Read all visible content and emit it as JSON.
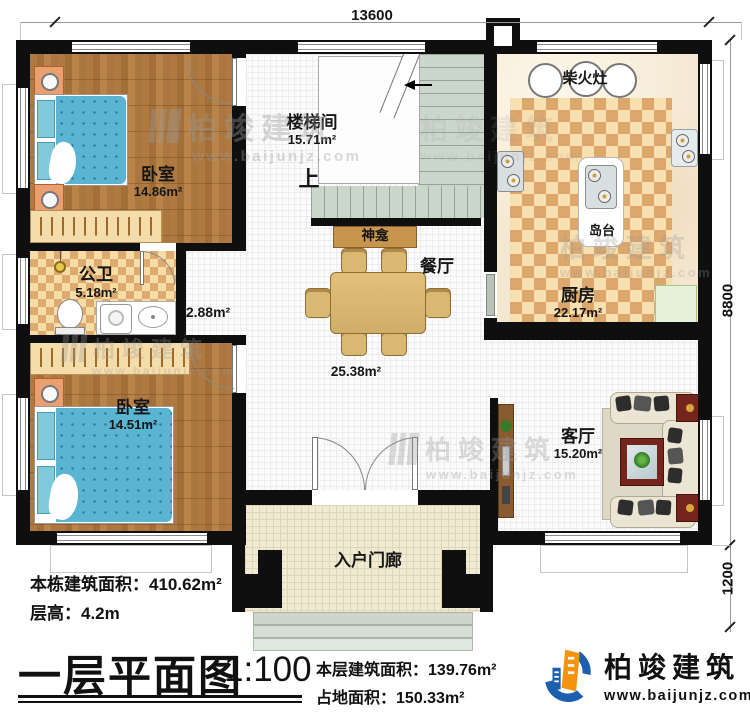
{
  "dimensions": {
    "top": "13600",
    "right_upper": "8800",
    "right_lower": "1200"
  },
  "rooms": {
    "bedroom_top": {
      "name": "卧室",
      "area": "14.86m²"
    },
    "stairwell": {
      "name": "楼梯间",
      "area": "15.71m²",
      "up_label": "上"
    },
    "kitchen": {
      "name": "厨房",
      "area": "22.17m²",
      "stove_label": "柴火灶",
      "island_label": "岛台"
    },
    "bathroom": {
      "name": "公卫",
      "area": "5.18m²"
    },
    "hallway": {
      "area": "2.88m²"
    },
    "dining": {
      "name": "餐厅",
      "area": "25.38m²",
      "shrine_label": "神龛"
    },
    "bedroom_bottom": {
      "name": "卧室",
      "area": "14.51m²"
    },
    "living": {
      "name": "客厅",
      "area": "15.20m²"
    },
    "porch": {
      "name": "入户门廊"
    }
  },
  "info": {
    "building_area_label": "本栋建筑面积：",
    "building_area_value": "410.62m²",
    "floor_height_label": "层高：",
    "floor_height_value": "4.2m"
  },
  "title_block": {
    "title": "一层平面图",
    "scale": "1:100",
    "floor_area_label": "本层建筑面积：",
    "floor_area_value": "139.76m²",
    "land_area_label": "占地面积：",
    "land_area_value": "150.33m²"
  },
  "brand": {
    "name": "柏竣建筑",
    "website": "www.baijunjz.com"
  },
  "watermark": {
    "name": "柏竣建筑",
    "website": "www.baijunjz.com"
  },
  "colors": {
    "wall": "#0f0f0f",
    "wood": "#ab7840",
    "checker_tan": "#dba76c",
    "checker_cream": "#f7dfb0",
    "stair": "#ccd7cc",
    "bed_blue": "#5ab5d3",
    "brand_blue": "#1b5fae",
    "brand_orange": "#f5930f"
  }
}
